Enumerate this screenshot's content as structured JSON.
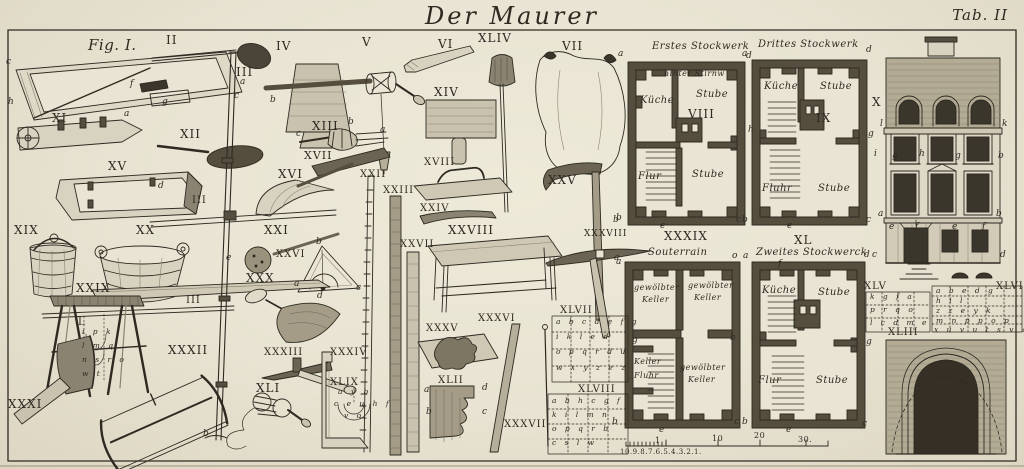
{
  "plate": {
    "title": "Der Maurer",
    "tab": "Tab. II"
  },
  "colors": {
    "paper": "#e9e4d3",
    "ink": "#2e2a22",
    "wall": "#554e3e",
    "dark": "#3b362c"
  },
  "labels": [
    {
      "t": "Fig. I.",
      "x": 88,
      "y": 38,
      "c": "sc",
      "s": 15
    },
    {
      "t": "II",
      "x": 166,
      "y": 34,
      "c": "rn"
    },
    {
      "t": "III",
      "x": 236,
      "y": 66,
      "c": "rn"
    },
    {
      "t": "IV",
      "x": 276,
      "y": 40,
      "c": "rn"
    },
    {
      "t": "V",
      "x": 362,
      "y": 36,
      "c": "rn"
    },
    {
      "t": "VI",
      "x": 438,
      "y": 38,
      "c": "rn"
    },
    {
      "t": "XLIV",
      "x": 478,
      "y": 32,
      "c": "rn"
    },
    {
      "t": "VII",
      "x": 562,
      "y": 40,
      "c": "rn"
    },
    {
      "t": "XI",
      "x": 52,
      "y": 112,
      "c": "rn"
    },
    {
      "t": "XII",
      "x": 180,
      "y": 128,
      "c": "rn"
    },
    {
      "t": "XIII",
      "x": 312,
      "y": 120,
      "c": "rn"
    },
    {
      "t": "XIV",
      "x": 434,
      "y": 86,
      "c": "rn"
    },
    {
      "t": "XV",
      "x": 108,
      "y": 160,
      "c": "rn"
    },
    {
      "t": "XVII",
      "x": 304,
      "y": 150,
      "c": "rn",
      "s": 11
    },
    {
      "t": "XVI",
      "x": 278,
      "y": 168,
      "c": "rn"
    },
    {
      "t": "XVIII",
      "x": 424,
      "y": 158,
      "c": "rn",
      "s": 10
    },
    {
      "t": "XIX",
      "x": 14,
      "y": 224,
      "c": "rn"
    },
    {
      "t": "XX",
      "x": 136,
      "y": 224,
      "c": "rn"
    },
    {
      "t": "XXI",
      "x": 264,
      "y": 224,
      "c": "rn"
    },
    {
      "t": "XXII",
      "x": 360,
      "y": 170,
      "c": "rn",
      "s": 10
    },
    {
      "t": "XXIII",
      "x": 383,
      "y": 186,
      "c": "rn",
      "s": 10
    },
    {
      "t": "XXIV",
      "x": 420,
      "y": 204,
      "c": "rn",
      "s": 10
    },
    {
      "t": "XXV",
      "x": 548,
      "y": 174,
      "c": "rn"
    },
    {
      "t": "XXVI",
      "x": 276,
      "y": 250,
      "c": "rn",
      "s": 10
    },
    {
      "t": "XXVII",
      "x": 400,
      "y": 240,
      "c": "rn",
      "s": 10
    },
    {
      "t": "XXVIII",
      "x": 448,
      "y": 224,
      "c": "rn"
    },
    {
      "t": "XXIX",
      "x": 76,
      "y": 282,
      "c": "rn"
    },
    {
      "t": "XXX",
      "x": 246,
      "y": 272,
      "c": "rn"
    },
    {
      "t": "III",
      "x": 192,
      "y": 196,
      "c": "rn",
      "s": 10
    },
    {
      "t": "III",
      "x": 186,
      "y": 296,
      "c": "rn",
      "s": 10
    },
    {
      "t": "XXXI",
      "x": 8,
      "y": 398,
      "c": "rn"
    },
    {
      "t": "XXXII",
      "x": 168,
      "y": 344,
      "c": "rn"
    },
    {
      "t": "XXXIII",
      "x": 264,
      "y": 348,
      "c": "rn",
      "s": 10
    },
    {
      "t": "XXXIV",
      "x": 330,
      "y": 348,
      "c": "rn",
      "s": 10
    },
    {
      "t": "XXXV",
      "x": 426,
      "y": 324,
      "c": "rn",
      "s": 10
    },
    {
      "t": "XXXVI",
      "x": 478,
      "y": 314,
      "c": "rn",
      "s": 10
    },
    {
      "t": "XXXVII",
      "x": 504,
      "y": 420,
      "c": "rn",
      "s": 10
    },
    {
      "t": "XXXVIII",
      "x": 584,
      "y": 230,
      "c": "rn",
      "s": 9
    },
    {
      "t": "XLI",
      "x": 256,
      "y": 382,
      "c": "rn"
    },
    {
      "t": "XLII",
      "x": 438,
      "y": 376,
      "c": "rn",
      "s": 10
    },
    {
      "t": "XLIX",
      "x": 330,
      "y": 378,
      "c": "rn",
      "s": 10
    },
    {
      "t": "L",
      "x": 78,
      "y": 318,
      "c": "rn",
      "s": 10
    },
    {
      "t": "VIII",
      "x": 688,
      "y": 108,
      "c": "rn"
    },
    {
      "t": "IX",
      "x": 816,
      "y": 112,
      "c": "rn"
    },
    {
      "t": "X",
      "x": 872,
      "y": 96,
      "c": "rn"
    },
    {
      "t": "XXXIX",
      "x": 664,
      "y": 230,
      "c": "rn"
    },
    {
      "t": "XL",
      "x": 794,
      "y": 234,
      "c": "rn"
    },
    {
      "t": "XLIII",
      "x": 888,
      "y": 328,
      "c": "rn",
      "s": 10
    },
    {
      "t": "XLV",
      "x": 864,
      "y": 282,
      "c": "rn",
      "s": 10
    },
    {
      "t": "XLVI",
      "x": 996,
      "y": 282,
      "c": "rn",
      "s": 10
    },
    {
      "t": "XLVII",
      "x": 560,
      "y": 306,
      "c": "rn",
      "s": 10
    },
    {
      "t": "XLVIII",
      "x": 578,
      "y": 385,
      "c": "rn",
      "s": 10
    },
    {
      "t": "Erstes Stockwerk",
      "x": 652,
      "y": 42,
      "c": "sc"
    },
    {
      "t": "Drittes Stockwerk",
      "x": 758,
      "y": 40,
      "c": "sc"
    },
    {
      "t": "Souterrain",
      "x": 648,
      "y": 248,
      "c": "sc"
    },
    {
      "t": "Zweites Stockwerck",
      "x": 756,
      "y": 248,
      "c": "sc"
    },
    {
      "t": "hinter Stirnw",
      "x": 664,
      "y": 70,
      "c": "sc",
      "s": 8
    },
    {
      "t": "Küche",
      "x": 640,
      "y": 96,
      "c": "sc"
    },
    {
      "t": "Stube",
      "x": 696,
      "y": 90,
      "c": "sc"
    },
    {
      "t": "Flur",
      "x": 638,
      "y": 172,
      "c": "sc"
    },
    {
      "t": "Stube",
      "x": 692,
      "y": 170,
      "c": "sc"
    },
    {
      "t": "Küche",
      "x": 764,
      "y": 82,
      "c": "sc"
    },
    {
      "t": "Stube",
      "x": 820,
      "y": 82,
      "c": "sc"
    },
    {
      "t": "Fluhr",
      "x": 762,
      "y": 184,
      "c": "sc"
    },
    {
      "t": "Stube",
      "x": 818,
      "y": 184,
      "c": "sc"
    },
    {
      "t": "gewölbter",
      "x": 634,
      "y": 284,
      "c": "sc",
      "s": 8
    },
    {
      "t": "Keller",
      "x": 642,
      "y": 296,
      "c": "sc",
      "s": 8
    },
    {
      "t": "gewölbter",
      "x": 688,
      "y": 282,
      "c": "sc",
      "s": 8
    },
    {
      "t": "Keller",
      "x": 694,
      "y": 294,
      "c": "sc",
      "s": 8
    },
    {
      "t": "Keller",
      "x": 634,
      "y": 358,
      "c": "sc",
      "s": 8
    },
    {
      "t": "Fluhr",
      "x": 634,
      "y": 372,
      "c": "sc",
      "s": 8
    },
    {
      "t": "gewölbter",
      "x": 680,
      "y": 364,
      "c": "sc",
      "s": 8
    },
    {
      "t": "Keller",
      "x": 688,
      "y": 376,
      "c": "sc",
      "s": 8
    },
    {
      "t": "Küche",
      "x": 762,
      "y": 286,
      "c": "sc"
    },
    {
      "t": "Stube",
      "x": 818,
      "y": 288,
      "c": "sc"
    },
    {
      "t": "Flur",
      "x": 758,
      "y": 376,
      "c": "sc"
    },
    {
      "t": "Stube",
      "x": 816,
      "y": 376,
      "c": "sc"
    },
    {
      "t": "c",
      "x": 6,
      "y": 58,
      "c": "lt"
    },
    {
      "t": "h",
      "x": 8,
      "y": 98,
      "c": "lt"
    },
    {
      "t": "f",
      "x": 130,
      "y": 80,
      "c": "lt"
    },
    {
      "t": "g",
      "x": 162,
      "y": 98,
      "c": "lt"
    },
    {
      "t": "a",
      "x": 124,
      "y": 110,
      "c": "lt"
    },
    {
      "t": "b",
      "x": 270,
      "y": 96,
      "c": "lt"
    },
    {
      "t": "a",
      "x": 240,
      "y": 78,
      "c": "lt"
    },
    {
      "t": "c",
      "x": 234,
      "y": 92,
      "c": "lt"
    },
    {
      "t": "e",
      "x": 226,
      "y": 254,
      "c": "lt"
    },
    {
      "t": "b",
      "x": 203,
      "y": 430,
      "c": "lt"
    },
    {
      "t": "c",
      "x": 296,
      "y": 130,
      "c": "lt"
    },
    {
      "t": "b",
      "x": 348,
      "y": 118,
      "c": "lt"
    },
    {
      "t": "a",
      "x": 380,
      "y": 126,
      "c": "lt"
    },
    {
      "t": "d",
      "x": 158,
      "y": 182,
      "c": "lt"
    },
    {
      "t": "b",
      "x": 316,
      "y": 238,
      "c": "lt"
    },
    {
      "t": "a",
      "x": 294,
      "y": 280,
      "c": "lt"
    },
    {
      "t": "d",
      "x": 317,
      "y": 292,
      "c": "lt"
    },
    {
      "t": "c",
      "x": 356,
      "y": 284,
      "c": "lt"
    },
    {
      "t": "b",
      "x": 616,
      "y": 214,
      "c": "lt"
    },
    {
      "t": "a",
      "x": 616,
      "y": 258,
      "c": "lt"
    },
    {
      "t": "a",
      "x": 424,
      "y": 386,
      "c": "lt"
    },
    {
      "t": "d",
      "x": 482,
      "y": 384,
      "c": "lt"
    },
    {
      "t": "b",
      "x": 426,
      "y": 408,
      "c": "lt"
    },
    {
      "t": "c",
      "x": 482,
      "y": 408,
      "c": "lt"
    },
    {
      "t": "a",
      "x": 618,
      "y": 50,
      "c": "lt"
    },
    {
      "t": "d",
      "x": 746,
      "y": 52,
      "c": "lt"
    },
    {
      "t": "h",
      "x": 748,
      "y": 126,
      "c": "lt"
    },
    {
      "t": "b",
      "x": 613,
      "y": 216,
      "c": "lt"
    },
    {
      "t": "c",
      "x": 736,
      "y": 216,
      "c": "lt"
    },
    {
      "t": "e",
      "x": 660,
      "y": 222,
      "c": "lt"
    },
    {
      "t": "a",
      "x": 742,
      "y": 50,
      "c": "lt"
    },
    {
      "t": "d",
      "x": 866,
      "y": 46,
      "c": "lt"
    },
    {
      "t": "g",
      "x": 868,
      "y": 130,
      "c": "lt"
    },
    {
      "t": "b",
      "x": 742,
      "y": 216,
      "c": "lt"
    },
    {
      "t": "c",
      "x": 866,
      "y": 216,
      "c": "lt"
    },
    {
      "t": "e",
      "x": 787,
      "y": 222,
      "c": "lt"
    },
    {
      "t": "a",
      "x": 614,
      "y": 254,
      "c": "lt"
    },
    {
      "t": "o",
      "x": 732,
      "y": 252,
      "c": "lt"
    },
    {
      "t": "g",
      "x": 632,
      "y": 336,
      "c": "lt"
    },
    {
      "t": "h",
      "x": 730,
      "y": 334,
      "c": "lt"
    },
    {
      "t": "b",
      "x": 612,
      "y": 418,
      "c": "lt"
    },
    {
      "t": "c",
      "x": 734,
      "y": 418,
      "c": "lt"
    },
    {
      "t": "e",
      "x": 659,
      "y": 426,
      "c": "lt"
    },
    {
      "t": "a",
      "x": 743,
      "y": 252,
      "c": "lt"
    },
    {
      "t": "d",
      "x": 864,
      "y": 251,
      "c": "lt"
    },
    {
      "t": "f",
      "x": 778,
      "y": 260,
      "c": "lt"
    },
    {
      "t": "g",
      "x": 866,
      "y": 338,
      "c": "lt"
    },
    {
      "t": "b",
      "x": 742,
      "y": 418,
      "c": "lt"
    },
    {
      "t": "c",
      "x": 862,
      "y": 420,
      "c": "lt"
    },
    {
      "t": "e",
      "x": 786,
      "y": 426,
      "c": "lt"
    },
    {
      "t": "l",
      "x": 880,
      "y": 120,
      "c": "lt"
    },
    {
      "t": "k",
      "x": 1002,
      "y": 120,
      "c": "lt"
    },
    {
      "t": "i",
      "x": 874,
      "y": 150,
      "c": "lt"
    },
    {
      "t": "g",
      "x": 892,
      "y": 152,
      "c": "lt"
    },
    {
      "t": "h",
      "x": 919,
      "y": 150,
      "c": "lt"
    },
    {
      "t": "g",
      "x": 955,
      "y": 152,
      "c": "lt"
    },
    {
      "t": "b",
      "x": 998,
      "y": 152,
      "c": "lt"
    },
    {
      "t": "a",
      "x": 878,
      "y": 210,
      "c": "lt"
    },
    {
      "t": "b",
      "x": 996,
      "y": 210,
      "c": "lt"
    },
    {
      "t": "e",
      "x": 889,
      "y": 223,
      "c": "lt"
    },
    {
      "t": "f",
      "x": 915,
      "y": 223,
      "c": "lt"
    },
    {
      "t": "e",
      "x": 952,
      "y": 223,
      "c": "lt"
    },
    {
      "t": "f",
      "x": 982,
      "y": 223,
      "c": "lt"
    },
    {
      "t": "c",
      "x": 872,
      "y": 251,
      "c": "lt"
    },
    {
      "t": "d",
      "x": 1000,
      "y": 251,
      "c": "lt"
    },
    {
      "t": "a b c d e f g",
      "x": 556,
      "y": 318,
      "c": "gr"
    },
    {
      "t": "i k l e d",
      "x": 556,
      "y": 333,
      "c": "gr"
    },
    {
      "t": "o p q r d u",
      "x": 556,
      "y": 348,
      "c": "gr"
    },
    {
      "t": "w x y z e z",
      "x": 556,
      "y": 364,
      "c": "gr"
    },
    {
      "t": "a b h c g f",
      "x": 552,
      "y": 397,
      "c": "gr"
    },
    {
      "t": "k i l m n",
      "x": 552,
      "y": 411,
      "c": "gr"
    },
    {
      "t": "o p q r b",
      "x": 552,
      "y": 425,
      "c": "gr"
    },
    {
      "t": "c s l w",
      "x": 552,
      "y": 439,
      "c": "gr"
    },
    {
      "t": "k g f a",
      "x": 870,
      "y": 293,
      "c": "gr"
    },
    {
      "t": "p r q o",
      "x": 870,
      "y": 306,
      "c": "gr"
    },
    {
      "t": "l c d m e",
      "x": 870,
      "y": 319,
      "c": "gr"
    },
    {
      "t": "a b e d g",
      "x": 936,
      "y": 287,
      "c": "gr"
    },
    {
      "t": "h i l",
      "x": 936,
      "y": 297,
      "c": "gr"
    },
    {
      "t": "z z e y k",
      "x": 936,
      "y": 307,
      "c": "gr"
    },
    {
      "t": "m n p p o p",
      "x": 936,
      "y": 317,
      "c": "gr"
    },
    {
      "t": "x u v u t s v q",
      "x": 934,
      "y": 326,
      "c": "gr"
    },
    {
      "t": "a y b",
      "x": 338,
      "y": 388,
      "c": "gr"
    },
    {
      "t": "c e u h f",
      "x": 334,
      "y": 400,
      "c": "gr"
    },
    {
      "t": "v o",
      "x": 344,
      "y": 412,
      "c": "gr"
    },
    {
      "t": "i p k",
      "x": 82,
      "y": 328,
      "c": "gr"
    },
    {
      "t": "l m q",
      "x": 82,
      "y": 342,
      "c": "gr"
    },
    {
      "t": "n s r o",
      "x": 82,
      "y": 356,
      "c": "gr"
    },
    {
      "t": "w t",
      "x": 82,
      "y": 370,
      "c": "gr"
    },
    {
      "t": "10.9.8.7.6.5.4.3.2.1.",
      "x": 620,
      "y": 449,
      "c": "sm",
      "s": 7
    },
    {
      "t": "1",
      "x": 655,
      "y": 437,
      "c": "sm"
    },
    {
      "t": "10",
      "x": 712,
      "y": 435,
      "c": "sm"
    },
    {
      "t": "20",
      "x": 754,
      "y": 432,
      "c": "sm"
    },
    {
      "t": "30.",
      "x": 798,
      "y": 436,
      "c": "sm"
    }
  ]
}
